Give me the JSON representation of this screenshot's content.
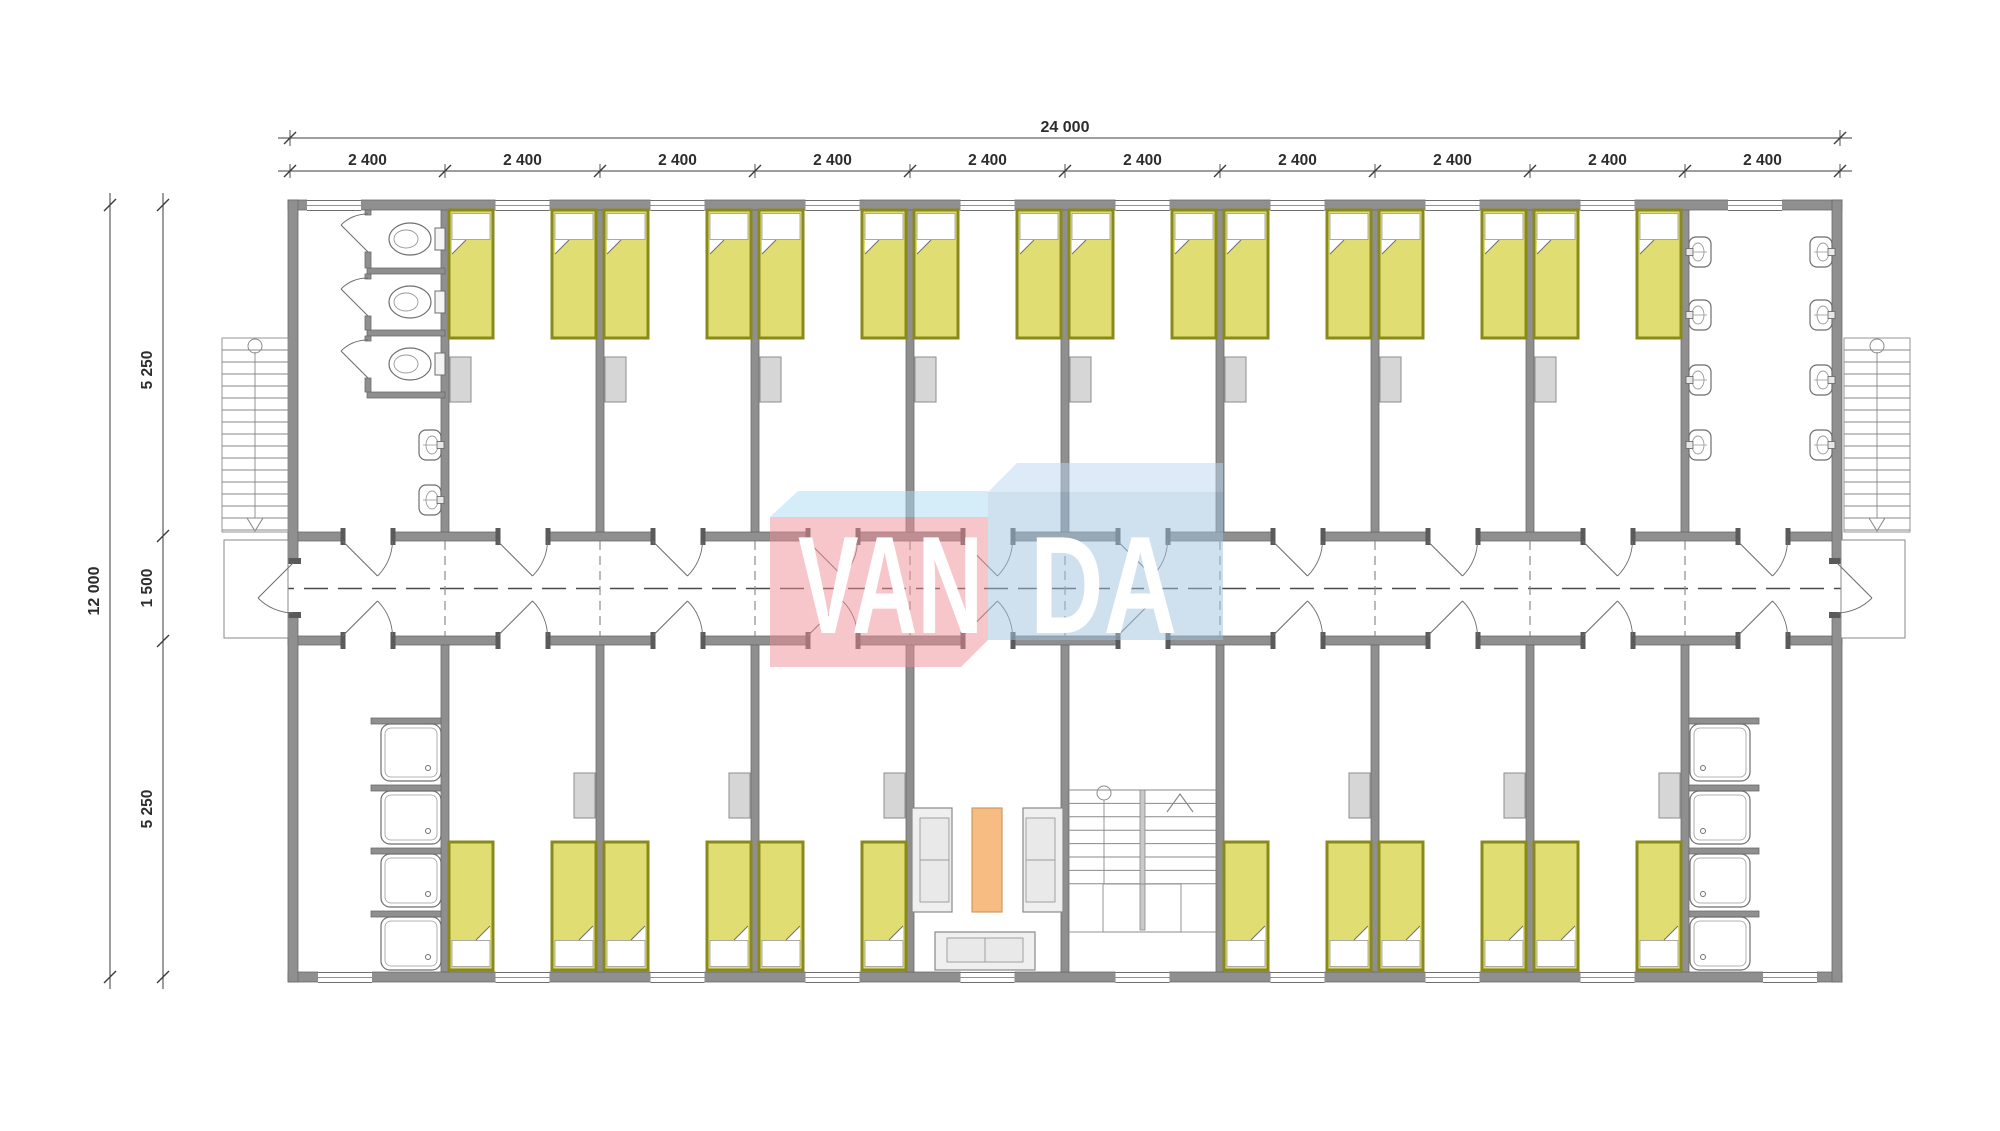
{
  "dimensions": {
    "total_width": "24 000",
    "bays": [
      "2 400",
      "2 400",
      "2 400",
      "2 400",
      "2 400",
      "2 400",
      "2 400",
      "2 400",
      "2 400",
      "2 400"
    ],
    "total_height": "12 000",
    "vertical_segments": [
      "5 250",
      "1 500",
      "5 250"
    ]
  },
  "watermark": {
    "text": "VANDA",
    "left_part": "VAN",
    "right_part": "DA"
  },
  "colors": {
    "wall": "#8f8f8f",
    "wall_edge": "#6b6b6b",
    "jamb": "#5a5a5a",
    "line": "#6e6e6e",
    "stair_line": "#8a8a8a",
    "dash_axis": "#4a4a4a",
    "dash_wall": "#8c8c8c",
    "bed_border": "#8a8a1c",
    "bed_blanket": "#e0dd72",
    "pillow": "#ffffff",
    "locker_fill": "#d6d6d6",
    "locker_edge": "#8e8e8e",
    "fixture_fill": "#ffffff",
    "fixture_inner": "#9a9a9a",
    "sofa_fill": "#efefef",
    "cushion_fill": "#e9e9e9",
    "table_fill": "#f6bc81",
    "table_edge": "#cf9a60",
    "dim_text": "#2d2d2d",
    "dim_line": "#3c3c3c",
    "watermark_pink": "rgba(237,141,151,0.5)",
    "watermark_pink_top": "rgba(170,220,243,0.5)",
    "watermark_blue": "rgba(159,193,223,0.5)",
    "watermark_blue_top": "rgba(185,216,240,0.5)",
    "watermark_letters": "#ffffff"
  }
}
